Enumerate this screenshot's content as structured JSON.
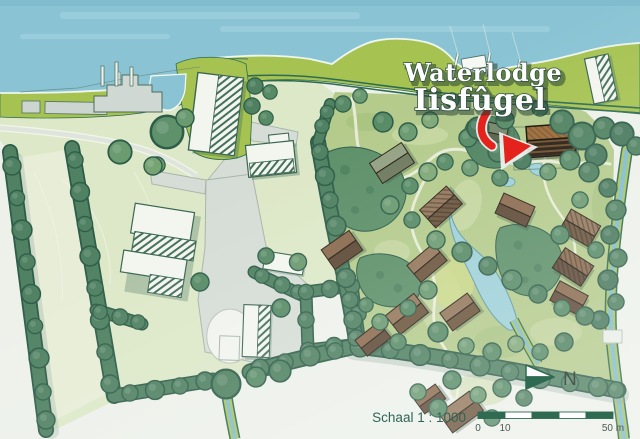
{
  "map": {
    "annotation": {
      "line1": "Waterlodge",
      "line2": "Iisfûgel"
    },
    "scale": {
      "label": "Schaal 1 : 1000",
      "ticks": [
        "0",
        "10",
        "50 m"
      ]
    },
    "compass": {
      "label": "N"
    },
    "colors": {
      "water": "#8ac4d4",
      "dike_green": "#a6c352",
      "dike_stripe": "#2e6b52",
      "park_grass": "#b4cb8c",
      "field_green": "#dde8c8",
      "hedge_green": "#4f8162",
      "hedge_outline": "#2d5c48",
      "building_white": "#f3f5ef",
      "building_outline": "#3a6652",
      "road_gray": "#d6ddd6",
      "pond_blue": "#9ed0d8",
      "lodge_brown": "#93765a",
      "target_lodge_brown": "#9c6a36",
      "arrow_red": "#e3231c",
      "label_green": "#2f6457",
      "background": "#edf1ea"
    }
  }
}
